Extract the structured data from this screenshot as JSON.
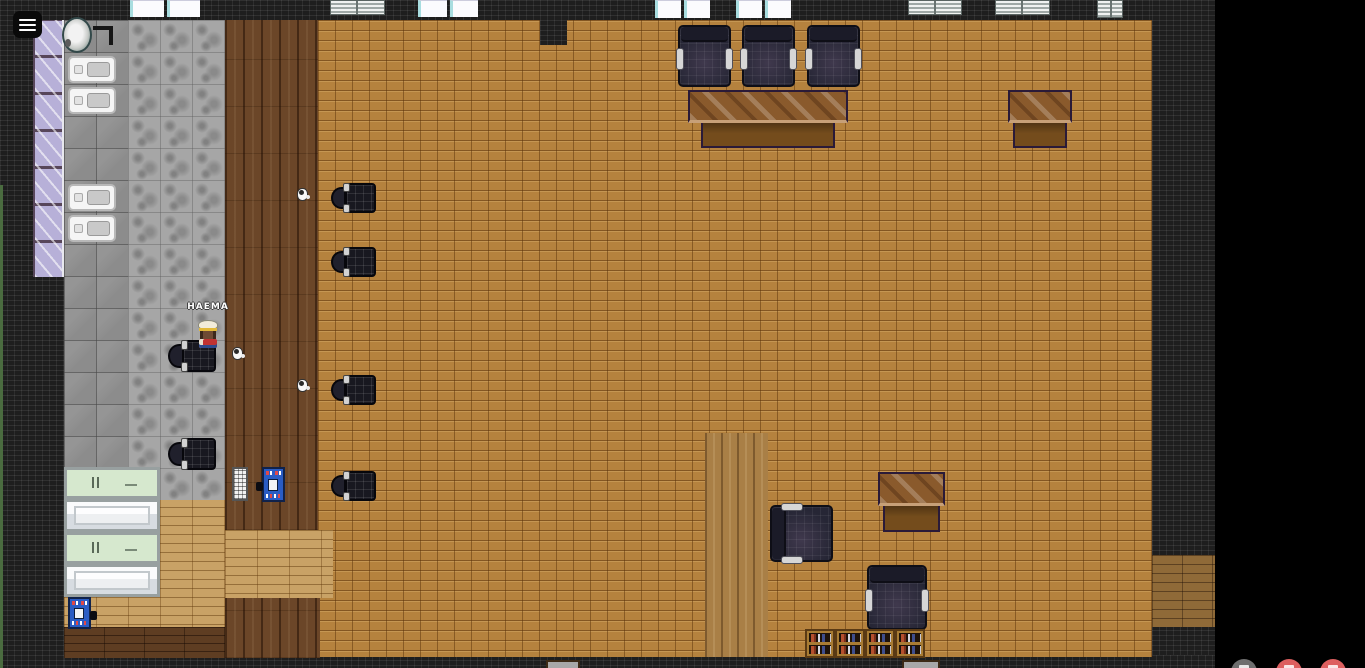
{
  "player": {
    "name": "HAEMA"
  },
  "ui": {
    "menu_button": {
      "icon": "hamburger-icon"
    },
    "call_controls": [
      {
        "id": "screen-share-button",
        "icon": "screen-share-icon",
        "color": "#6e6e6e",
        "x": 1231
      },
      {
        "id": "mic-button",
        "icon": "mic-icon",
        "color": "#dd5f5f",
        "x": 1276
      },
      {
        "id": "camera-button",
        "icon": "camera-icon",
        "color": "#dd5f5f",
        "x": 1320
      }
    ]
  },
  "scene": {
    "furniture": [
      {
        "type": "sink",
        "x": 62,
        "y": 17,
        "w": 30,
        "h": 36
      },
      {
        "type": "corner-mark",
        "x": 93,
        "y": 26,
        "w": 20,
        "h": 19
      },
      {
        "type": "stove",
        "x": 68,
        "y": 56,
        "w": 48,
        "h": 27
      },
      {
        "type": "stove",
        "x": 68,
        "y": 87,
        "w": 48,
        "h": 27
      },
      {
        "type": "stove",
        "x": 68,
        "y": 184,
        "w": 48,
        "h": 27
      },
      {
        "type": "stove",
        "x": 68,
        "y": 215,
        "w": 48,
        "h": 27
      },
      {
        "type": "window-white",
        "x": 130,
        "y": 0,
        "w": 70,
        "h": 17
      },
      {
        "type": "window-blinds",
        "x": 330,
        "y": 0,
        "w": 55,
        "h": 15
      },
      {
        "type": "window-white",
        "x": 418,
        "y": 0,
        "w": 60,
        "h": 17
      },
      {
        "type": "window-white",
        "x": 655,
        "y": 0,
        "w": 55,
        "h": 18
      },
      {
        "type": "window-white",
        "x": 736,
        "y": 0,
        "w": 55,
        "h": 18
      },
      {
        "type": "window-blinds",
        "x": 908,
        "y": 0,
        "w": 54,
        "h": 15
      },
      {
        "type": "window-blinds",
        "x": 995,
        "y": 0,
        "w": 55,
        "h": 15
      },
      {
        "type": "window-blinds",
        "x": 1097,
        "y": 0,
        "w": 26,
        "h": 18
      },
      {
        "type": "armchair",
        "x": 678,
        "y": 25,
        "w": 53,
        "h": 62,
        "variant": "down"
      },
      {
        "type": "armchair",
        "x": 742,
        "y": 25,
        "w": 53,
        "h": 62,
        "variant": "down"
      },
      {
        "type": "armchair",
        "x": 807,
        "y": 25,
        "w": 53,
        "h": 62,
        "variant": "down"
      },
      {
        "type": "desk",
        "x": 688,
        "y": 90,
        "w": 160,
        "h": 58
      },
      {
        "type": "desk",
        "x": 1008,
        "y": 90,
        "w": 64,
        "h": 58
      },
      {
        "type": "office-chair",
        "x": 331,
        "y": 183,
        "w": 45,
        "h": 30,
        "variant": "left"
      },
      {
        "type": "office-chair",
        "x": 331,
        "y": 247,
        "w": 45,
        "h": 30,
        "variant": "left"
      },
      {
        "type": "office-chair",
        "x": 331,
        "y": 375,
        "w": 45,
        "h": 30,
        "variant": "left"
      },
      {
        "type": "office-chair",
        "x": 331,
        "y": 471,
        "w": 45,
        "h": 30,
        "variant": "left"
      },
      {
        "type": "office-chair",
        "x": 168,
        "y": 340,
        "w": 48,
        "h": 32,
        "variant": "left"
      },
      {
        "type": "office-chair",
        "x": 168,
        "y": 438,
        "w": 48,
        "h": 32,
        "variant": "left"
      },
      {
        "type": "mug",
        "x": 297,
        "y": 188,
        "w": 11,
        "h": 13
      },
      {
        "type": "mug",
        "x": 232,
        "y": 347,
        "w": 11,
        "h": 13
      },
      {
        "type": "mug",
        "x": 297,
        "y": 379,
        "w": 11,
        "h": 13
      },
      {
        "type": "counter",
        "x": 64,
        "y": 467,
        "w": 96,
        "h": 32,
        "variant": "green"
      },
      {
        "type": "counter",
        "x": 64,
        "y": 499,
        "w": 96,
        "h": 33,
        "variant": "silver"
      },
      {
        "type": "counter",
        "x": 64,
        "y": 532,
        "w": 96,
        "h": 32,
        "variant": "green"
      },
      {
        "type": "counter",
        "x": 64,
        "y": 564,
        "w": 96,
        "h": 33,
        "variant": "silver"
      },
      {
        "type": "radiator",
        "x": 232,
        "y": 467,
        "w": 16,
        "h": 34
      },
      {
        "type": "vending-machine",
        "x": 262,
        "y": 467,
        "w": 23,
        "h": 35,
        "variant": "knob-left"
      },
      {
        "type": "vending-machine",
        "x": 68,
        "y": 597,
        "w": 23,
        "h": 32,
        "variant": "knob-right"
      },
      {
        "type": "desk",
        "x": 878,
        "y": 472,
        "w": 67,
        "h": 60
      },
      {
        "type": "armchair",
        "x": 770,
        "y": 505,
        "w": 63,
        "h": 57,
        "variant": "right"
      },
      {
        "type": "armchair",
        "x": 867,
        "y": 565,
        "w": 60,
        "h": 65,
        "variant": "down"
      },
      {
        "type": "bookshelf",
        "x": 805,
        "y": 629,
        "w": 30,
        "h": 29
      },
      {
        "type": "bookshelf",
        "x": 835,
        "y": 629,
        "w": 30,
        "h": 29
      },
      {
        "type": "bookshelf",
        "x": 865,
        "y": 629,
        "w": 30,
        "h": 29
      },
      {
        "type": "bookshelf",
        "x": 895,
        "y": 629,
        "w": 30,
        "h": 29
      },
      {
        "type": "cut-desk",
        "x": 546,
        "y": 660,
        "w": 34,
        "h": 8
      },
      {
        "type": "cut-desk",
        "x": 902,
        "y": 660,
        "w": 38,
        "h": 8
      }
    ]
  }
}
